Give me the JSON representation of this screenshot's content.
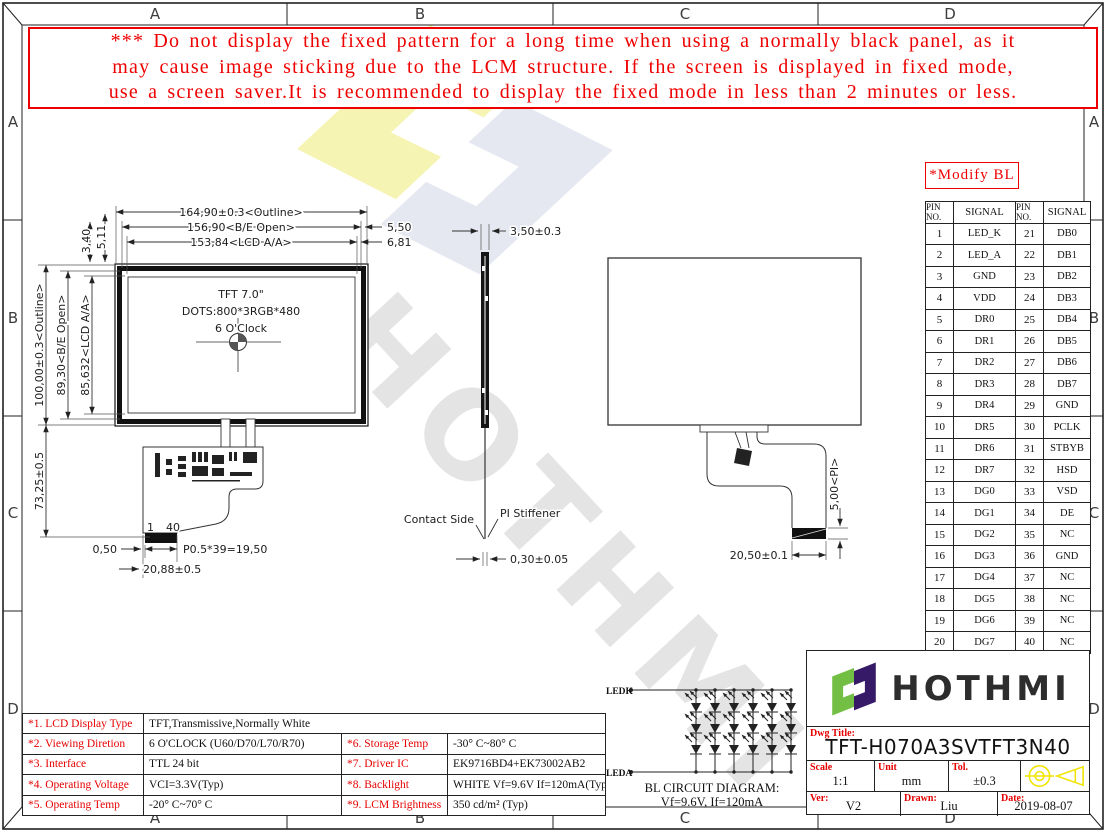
{
  "border": {
    "cols": [
      "A",
      "B",
      "C",
      "D"
    ],
    "rows": [
      "A",
      "B",
      "C",
      "D"
    ]
  },
  "warning": {
    "line1": "*** Do not display the fixed pattern for a long time when using a normally black panel, as it",
    "line2": "may cause image sticking due to the LCM structure. If the screen is displayed in fixed mode,",
    "line3": "use a screen saver.It is recommended to display the fixed mode in less than 2 minutes or less."
  },
  "modify_bl_label": "*Modify BL",
  "pin_table": {
    "headers": [
      "PIN NO.",
      "SIGNAL",
      "PIN NO.",
      "SIGNAL"
    ],
    "rows": [
      [
        "1",
        "LED_K",
        "21",
        "DB0"
      ],
      [
        "2",
        "LED_A",
        "22",
        "DB1"
      ],
      [
        "3",
        "GND",
        "23",
        "DB2"
      ],
      [
        "4",
        "VDD",
        "24",
        "DB3"
      ],
      [
        "5",
        "DR0",
        "25",
        "DB4"
      ],
      [
        "6",
        "DR1",
        "26",
        "DB5"
      ],
      [
        "7",
        "DR2",
        "27",
        "DB6"
      ],
      [
        "8",
        "DR3",
        "28",
        "DB7"
      ],
      [
        "9",
        "DR4",
        "29",
        "GND"
      ],
      [
        "10",
        "DR5",
        "30",
        "PCLK"
      ],
      [
        "11",
        "DR6",
        "31",
        "STBYB"
      ],
      [
        "12",
        "DR7",
        "32",
        "HSD"
      ],
      [
        "13",
        "DG0",
        "33",
        "VSD"
      ],
      [
        "14",
        "DG1",
        "34",
        "DE"
      ],
      [
        "15",
        "DG2",
        "35",
        "NC"
      ],
      [
        "16",
        "DG3",
        "36",
        "GND"
      ],
      [
        "17",
        "DG4",
        "37",
        "NC"
      ],
      [
        "18",
        "DG5",
        "38",
        "NC"
      ],
      [
        "19",
        "DG6",
        "39",
        "NC"
      ],
      [
        "20",
        "DG7",
        "40",
        "NC"
      ]
    ]
  },
  "front_view": {
    "title_line1": "TFT 7.0\"",
    "title_line2": "DOTS:800*3RGB*480",
    "title_line3": "6 O'Clock",
    "dim_outline_w": "164,90±0.3<Outline>",
    "dim_be_w": "156,90<B/E Open>",
    "dim_aa_w": "153,84<LCD A/A>",
    "dim_550": "5,50",
    "dim_681": "6,81",
    "dim_511": "5,11",
    "dim_340": "3,40",
    "dim_outline_h": "100,00±0.3<Outline>",
    "dim_be_h": "89,30<B/E Open>",
    "dim_aa_h": "85,632<LCD A/A>",
    "dim_fpc_len": "73,25±0.5",
    "dim_050": "0,50",
    "dim_pitch": "P0.5*39=19,50",
    "dim_conn_w": "20,88±0.5",
    "pin_first": "1",
    "pin_last": "40"
  },
  "side_view": {
    "dim_thickness": "3,50±0.3",
    "label_contact": "Contact Side",
    "label_stiffener": "PI Stiffener",
    "dim_fpc_thickness": "0,30±0.05"
  },
  "back_view": {
    "dim_pi": "5,00<PI>",
    "dim_conn": "20,50±0.1"
  },
  "bl_circuit": {
    "label_ledk": "LEDK",
    "label_leda": "LEDA",
    "title": "BL CIRCUIT DIAGRAM:",
    "subtitle": "Vf=9.6V, If=120mA"
  },
  "spec_table": {
    "row1_label": "*1. LCD Display Type",
    "row1_value": "TFT,Transmissive,Normally White",
    "rows": [
      {
        "l1": "*2. Viewing Diretion",
        "v1": "6 O'CLOCK (U60/D70/L70/R70)",
        "l2": "*6. Storage Temp",
        "v2": "-30° C~80° C"
      },
      {
        "l1": "*3. Interface",
        "v1": "TTL 24 bit",
        "l2": "*7. Driver IC",
        "v2": "EK9716BD4+EK73002AB2"
      },
      {
        "l1": "*4. Operating Voltage",
        "v1": "VCI=3.3V(Typ)",
        "l2": "*8. Backlight",
        "v2": "WHITE Vf=9.6V If=120mA(Typ)"
      },
      {
        "l1": "*5. Operating Temp",
        "v1": "-20° C~70° C",
        "l2": "*9. LCM Brightness",
        "v2": "350 cd/m² (Typ)"
      }
    ]
  },
  "title_block": {
    "brand": "HOTHMI",
    "dwg_title_label": "Dwg Title:",
    "dwg_title": "TFT-H070A3SVTFT3N40",
    "scale_label": "Scale",
    "scale_value": "1:1",
    "unit_label": "Unit",
    "unit_value": "mm",
    "tol_label": "Tol.",
    "tol_value": "±0.3",
    "ver_label": "Ver:",
    "ver_value": "V2",
    "drawn_label": "Drawn:",
    "drawn_value": "Liu",
    "date_label": "Date:",
    "date_value": "2019-08-07"
  },
  "watermark_text": "HOTHMI",
  "colors": {
    "accent_red": "#ee0000",
    "logo_green": "#72bf44",
    "logo_purple": "#371a67",
    "projection_yellow": "#f0e400"
  }
}
